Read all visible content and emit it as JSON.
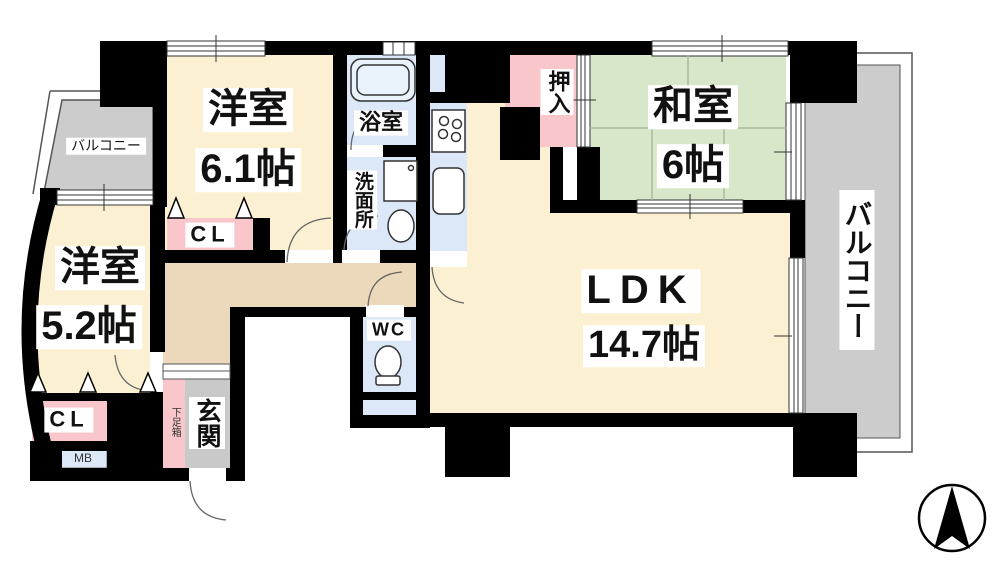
{
  "floorplan": {
    "type": "apartment-floor-plan",
    "labels": {
      "balcony_left": "バルコニー",
      "western_room1_name": "洋室",
      "western_room1_size": "6.1帖",
      "bath": "浴室",
      "washroom": "洗面所",
      "oshiire": "押入",
      "japanese_room_name": "和室",
      "japanese_room_size": "6帖",
      "balcony_right": "バルコニー",
      "western_room2_name": "洋室",
      "western_room2_size": "5.2帖",
      "closet_top": "CL",
      "closet_bottom": "CL",
      "meter_box": "MB",
      "shoe_box": "下足箱",
      "entrance": "玄関",
      "wc": "WC",
      "ldk_name": "LDK",
      "ldk_size": "14.7帖"
    },
    "colors": {
      "wall": "#000000",
      "room_cream": "#fbf1d2",
      "hall_beige": "#ecd9bc",
      "tatami_green": "#d8e7ca",
      "water_blue": "#dce8f7",
      "closet_pink": "#f9c6cc",
      "balcony_grey": "#cccccc",
      "entrance_grey": "#c9c9c9"
    },
    "compass": {
      "points": "north"
    }
  }
}
